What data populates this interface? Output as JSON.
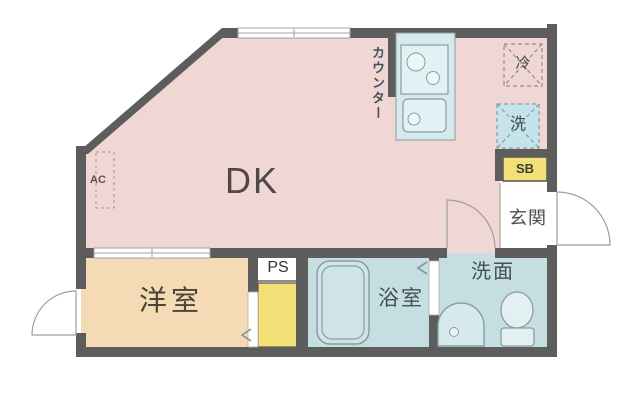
{
  "plan": {
    "rooms": {
      "dk": "DK",
      "western_room": "洋室",
      "bathroom": "浴室",
      "washroom": "洗面",
      "entrance": "玄関"
    },
    "features": {
      "counter": "カウンター",
      "pipe_space": "PS",
      "shoe_box": "SB",
      "fridge_space": "冷",
      "washer_space": "洗",
      "air_conditioner": "AC"
    }
  },
  "colors": {
    "wall": "#5d5d5d",
    "dk_floor": "#f1d7d3",
    "western_floor": "#f4dbb5",
    "wet_floor": "#c5dee1",
    "fixture": "#d6e9ec",
    "storage_yellow": "#f2e077",
    "door_line": "#9aa0a4",
    "label_text": "#474747"
  }
}
